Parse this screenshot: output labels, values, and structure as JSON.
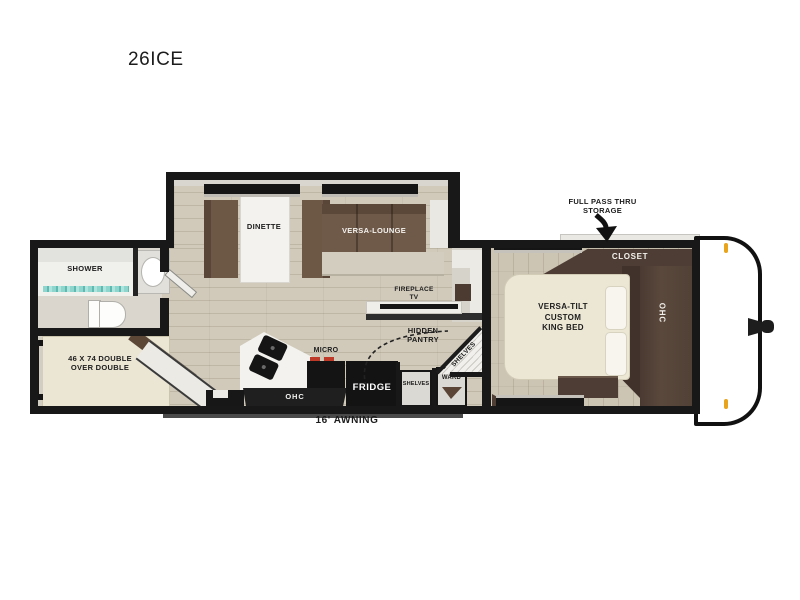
{
  "title": "26ICE",
  "annotations": {
    "storage": {
      "line1": "FULL PASS THRU",
      "line2": "STORAGE"
    },
    "awning": "16' AWNING"
  },
  "labels": {
    "dinette": "DINETTE",
    "versa_lounge": "VERSA-LOUNGE",
    "shower": "SHOWER",
    "bunk": {
      "line1": "46 X 74 DOUBLE",
      "line2": "OVER DOUBLE"
    },
    "micro": "MICRO",
    "fridge": "FRIDGE",
    "ohc_kitchen": "OHC",
    "shelves_corner": "SHELVES",
    "shelves_cabinet": "SHELVES",
    "ward": "WARD",
    "pantry": {
      "line1": "HIDDEN",
      "line2": "PANTRY"
    },
    "fireplace": {
      "line1": "FIREPLACE",
      "line2": "TV"
    },
    "closet": "CLOSET",
    "ohc_bedroom": "OHC",
    "bed": {
      "line1": "VERSA-TILT",
      "line2": "CUSTOM",
      "line3": "KING BED"
    }
  },
  "colors": {
    "wall": "#181818",
    "floor": "#d1cabb",
    "bedroom_floor": "#ccc5b4",
    "sofa_brown": "#6f5949",
    "dark_wood": "#4e3d34",
    "mattress_cream": "#ece7d5",
    "shower_teal": "#8ed5cd",
    "clearance_marker": "#e8a41c",
    "burner_red": "#bf3a28"
  }
}
